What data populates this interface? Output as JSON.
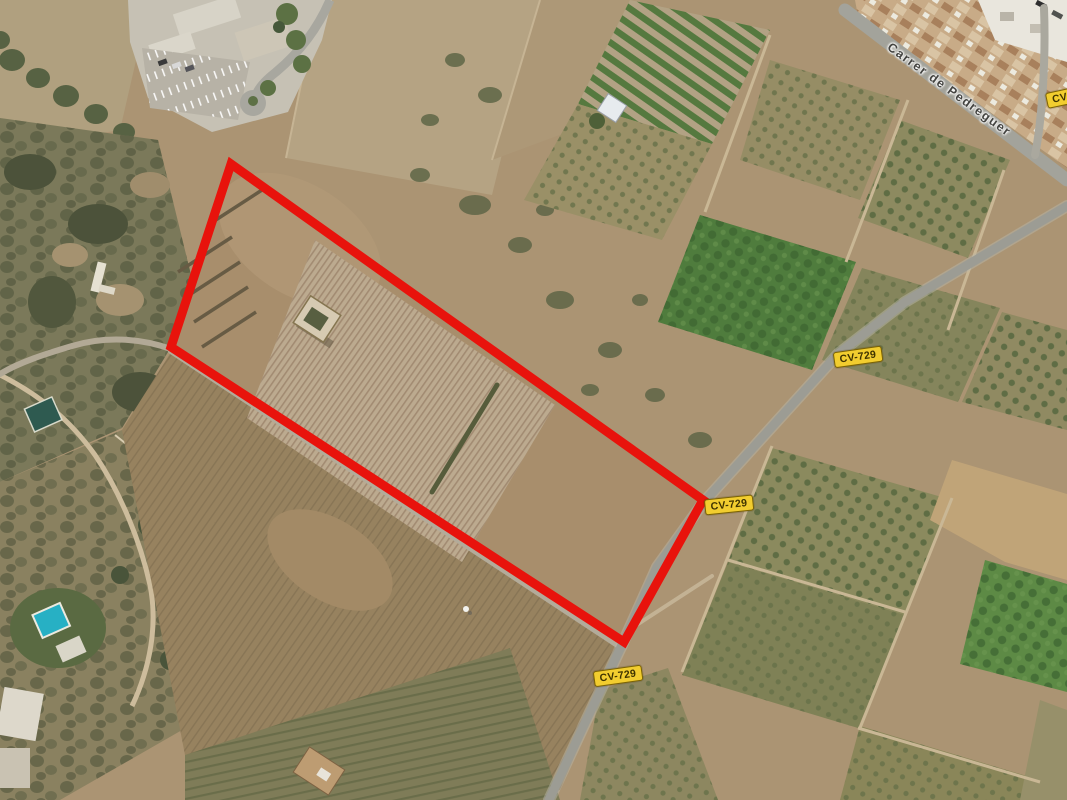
{
  "map": {
    "description": "Aerial satellite view of rural agricultural parcels with a highlighted land plot",
    "street_label": {
      "text": "Carrer de Pedreguer"
    },
    "route_badges": [
      {
        "text": "CV-729"
      },
      {
        "text": "CV-729"
      },
      {
        "text": "CV-729"
      },
      {
        "text": "CV-729"
      }
    ],
    "parcel_outline": {
      "color": "#e8130c",
      "stroke_width": 9,
      "vertices": [
        [
          231,
          164
        ],
        [
          171,
          347
        ],
        [
          624,
          642
        ],
        [
          703,
          500
        ]
      ],
      "points_attr": "231,164 171,347 624,642 703,500"
    },
    "colors": {
      "badge_background": "#f2cd2f",
      "badge_border": "#7c6302",
      "badge_text": "#3f3300",
      "road_grey": "#9c9c94",
      "rural_track": "#b3ab9a",
      "street_label_text": "#434340",
      "terrain_base": "#ab9473",
      "orchard_green": "#4f7c3d",
      "scrub_dark": "#4c523a",
      "pool_blue": "#27b0c4"
    }
  }
}
